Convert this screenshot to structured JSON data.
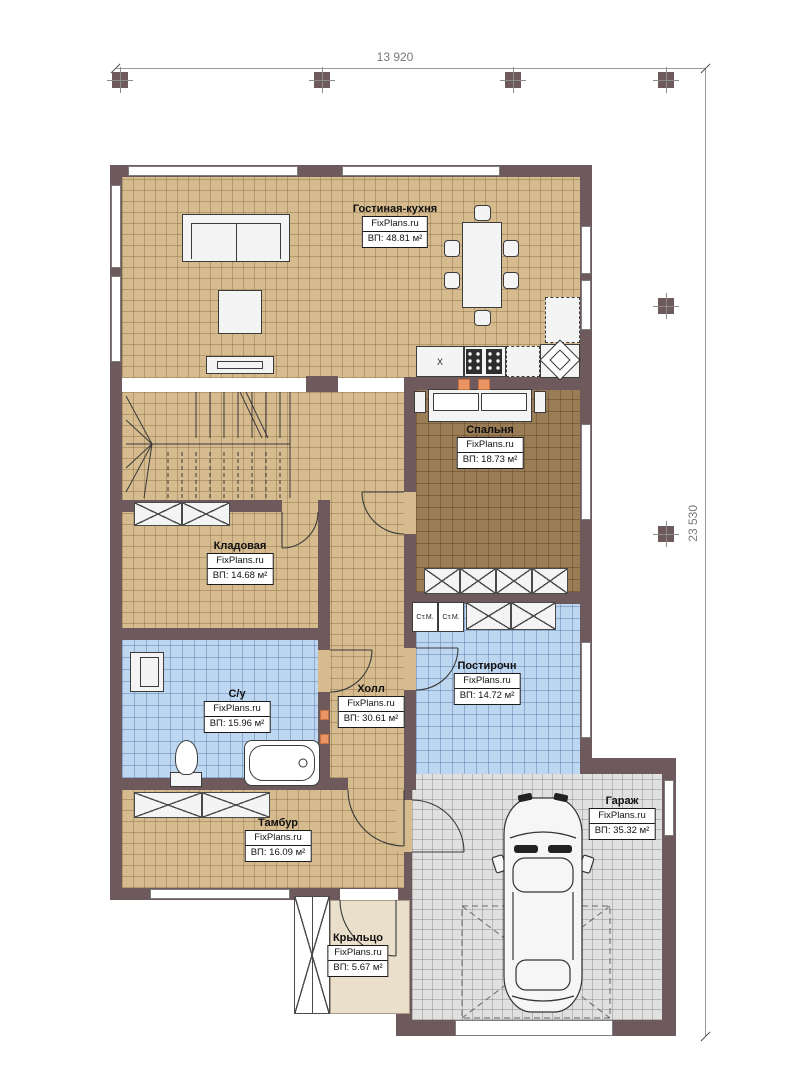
{
  "plan_title": "floor-plan",
  "dimensions": {
    "top": "13 920",
    "right": "23 530"
  },
  "brand": "FixPlans.ru",
  "rooms": [
    {
      "name": "Гостиная-кухня",
      "brand": "FixPlans.ru",
      "area": "ВП: 48.81 м²"
    },
    {
      "name": "Спальня",
      "brand": "FixPlans.ru",
      "area": "ВП: 18.73 м²"
    },
    {
      "name": "Кладовая",
      "brand": "FixPlans.ru",
      "area": "ВП: 14.68 м²"
    },
    {
      "name": "С/у",
      "brand": "FixPlans.ru",
      "area": "ВП: 15.96 м²"
    },
    {
      "name": "Холл",
      "brand": "FixPlans.ru",
      "area": "ВП: 30.61 м²"
    },
    {
      "name": "Постирочн",
      "brand": "FixPlans.ru",
      "area": "ВП: 14.72 м²"
    },
    {
      "name": "Тамбур",
      "brand": "FixPlans.ru",
      "area": "ВП: 16.09 м²"
    },
    {
      "name": "Гараж",
      "brand": "FixPlans.ru",
      "area": "ВП: 35.32 м²"
    },
    {
      "name": "Крыльцо",
      "brand": "FixPlans.ru",
      "area": "ВП: 5.67 м²"
    }
  ],
  "appliances": {
    "washer_label": "Ст.М.",
    "sink_symbol": "X"
  },
  "colors": {
    "wall": "#6e5a5c",
    "floor_tan": "#d6bb8f",
    "floor_dark": "#9a7c55",
    "floor_blue": "#bdd7f1",
    "floor_gray": "#e0e0e0",
    "floor_porch": "#eadfca",
    "accent_orange": "#ea9464"
  }
}
